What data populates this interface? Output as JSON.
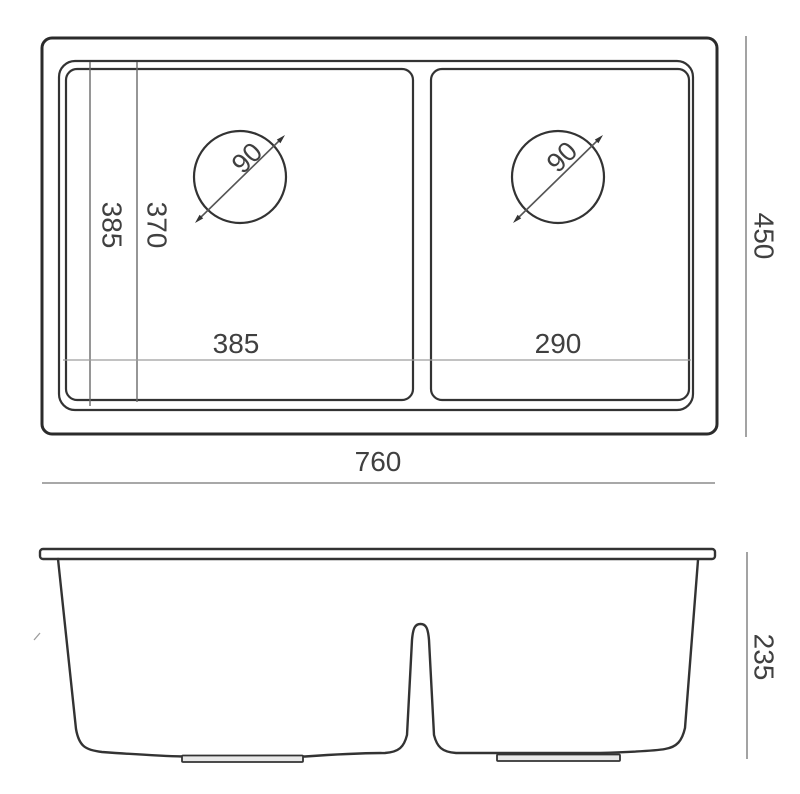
{
  "top_view": {
    "overall_width": "760",
    "overall_depth": "450",
    "left_bowl_width": "385",
    "right_bowl_width": "290",
    "left_vertical_dim": "385",
    "inner_vertical_dim": "370",
    "left_drain_diameter": "90",
    "right_drain_diameter": "90"
  },
  "front_view": {
    "overall_height": "235"
  },
  "colors": {
    "outline": "#333333",
    "outline_heavy": "#2b2b2b",
    "dimension_line": "#8c8c8c",
    "faint_line": "#9e9e9e",
    "label_text": "#404040",
    "background": "#ffffff"
  }
}
